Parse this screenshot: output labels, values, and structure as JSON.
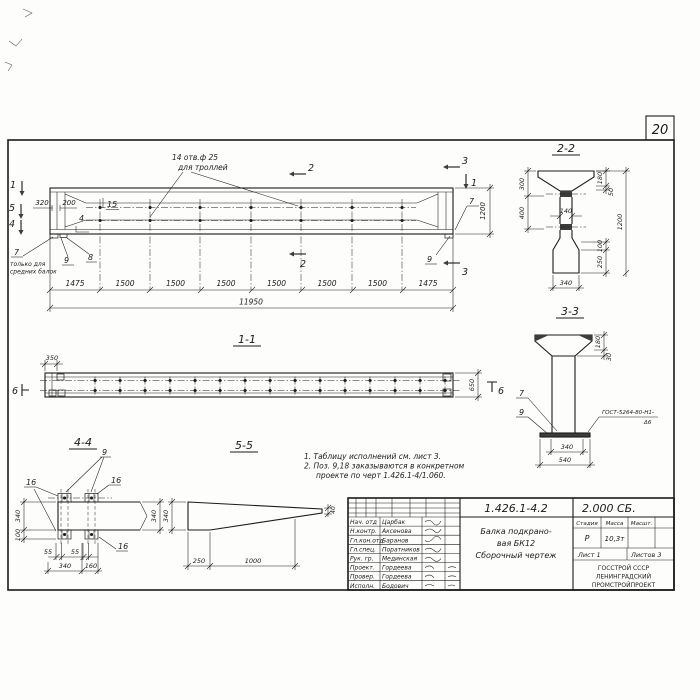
{
  "page_number": "20",
  "main_view": {
    "hole_note_l1": "14 отв.ф 25",
    "hole_note_l2": "для троллей",
    "marker_1": "1",
    "marker_5": "5",
    "marker_4": "4",
    "marker_2": "2",
    "marker_3": "3",
    "marker_6": "6",
    "dim_320": "320",
    "dim_200": "200",
    "callout_15": "15",
    "callout_4": "4",
    "callout_7": "7",
    "callout_7_note_l1": "только для",
    "callout_7_note_l2": "средних балок",
    "callout_8": "8",
    "callout_9": "9",
    "dim_1200": "1200",
    "segments": [
      "1475",
      "1500",
      "1500",
      "1500",
      "1500",
      "1500",
      "1500",
      "1475"
    ],
    "total": "11950"
  },
  "section_1_1": {
    "title": "1-1",
    "dim_350": "350",
    "dim_650": "650"
  },
  "section_2_2": {
    "title": "2-2",
    "dim_300": "300",
    "dim_400": "400",
    "dim_140": "140",
    "dim_180": "180",
    "dim_50": "50",
    "dim_1200": "1200",
    "dim_100": "100",
    "dim_250": "250",
    "dim_340": "340"
  },
  "section_3_3": {
    "title": "3-3",
    "dim_180": "180",
    "dim_30": "30",
    "dim_340": "340",
    "dim_540": "540",
    "callout_7": "7",
    "callout_9": "9",
    "weld_l1": "ГОСТ-5264-80-Н1-",
    "weld_l2": "Δ6"
  },
  "section_4_4": {
    "title": "4-4",
    "callout_9": "9",
    "callout_16": "16",
    "dim_340_left": "340",
    "dim_100": "100",
    "dim_340_right": "340",
    "dim_55": "55",
    "dim_340_bottom": "340",
    "dim_160": "160"
  },
  "section_5_5": {
    "title": "5-5",
    "dim_340": "340",
    "dim_250": "250",
    "dim_1000": "1000",
    "dim_40": "40"
  },
  "notes": {
    "line1": "1. Таблицу исполнений см. лист 3.",
    "line2": "2. Поз. 9,18 заказываются в конкретном",
    "line3": "проекте по черт 1.426.1-4/1.060."
  },
  "title_block": {
    "doc_number": "1.426.1-4.2",
    "doc_code": "2.000 СБ.",
    "rows": [
      {
        "role": "Нач. отд",
        "name": "Царбак"
      },
      {
        "role": "Н.контр.",
        "name": "Аксенова"
      },
      {
        "role": "Гл.кон.отд",
        "name": "Баранов"
      },
      {
        "role": "Гл.спец.",
        "name": "Поратников"
      },
      {
        "role": "Рук. гр.",
        "name": "Мединская"
      },
      {
        "role": "Проект.",
        "name": "Гордеева"
      },
      {
        "role": "Провер.",
        "name": "Гордеева"
      },
      {
        "role": "Исполн.",
        "name": "Бодович"
      }
    ],
    "title_l1": "Балка подкрано-",
    "title_l2": "вая БК12",
    "title_l3": "Сборочный чертеж",
    "stage_header": "Стадия",
    "mass_header": "Масса",
    "scale_header": "Масшт.",
    "stage": "Р",
    "mass": "10,3т",
    "sheet": "Лист 1",
    "sheets": "Листов 3",
    "org_l1": "ГОССТРОЙ СССР",
    "org_l2": "ЛЕНИНГРАДСКИЙ",
    "org_l3": "ПРОМСТРОЙПРОЕКТ"
  }
}
